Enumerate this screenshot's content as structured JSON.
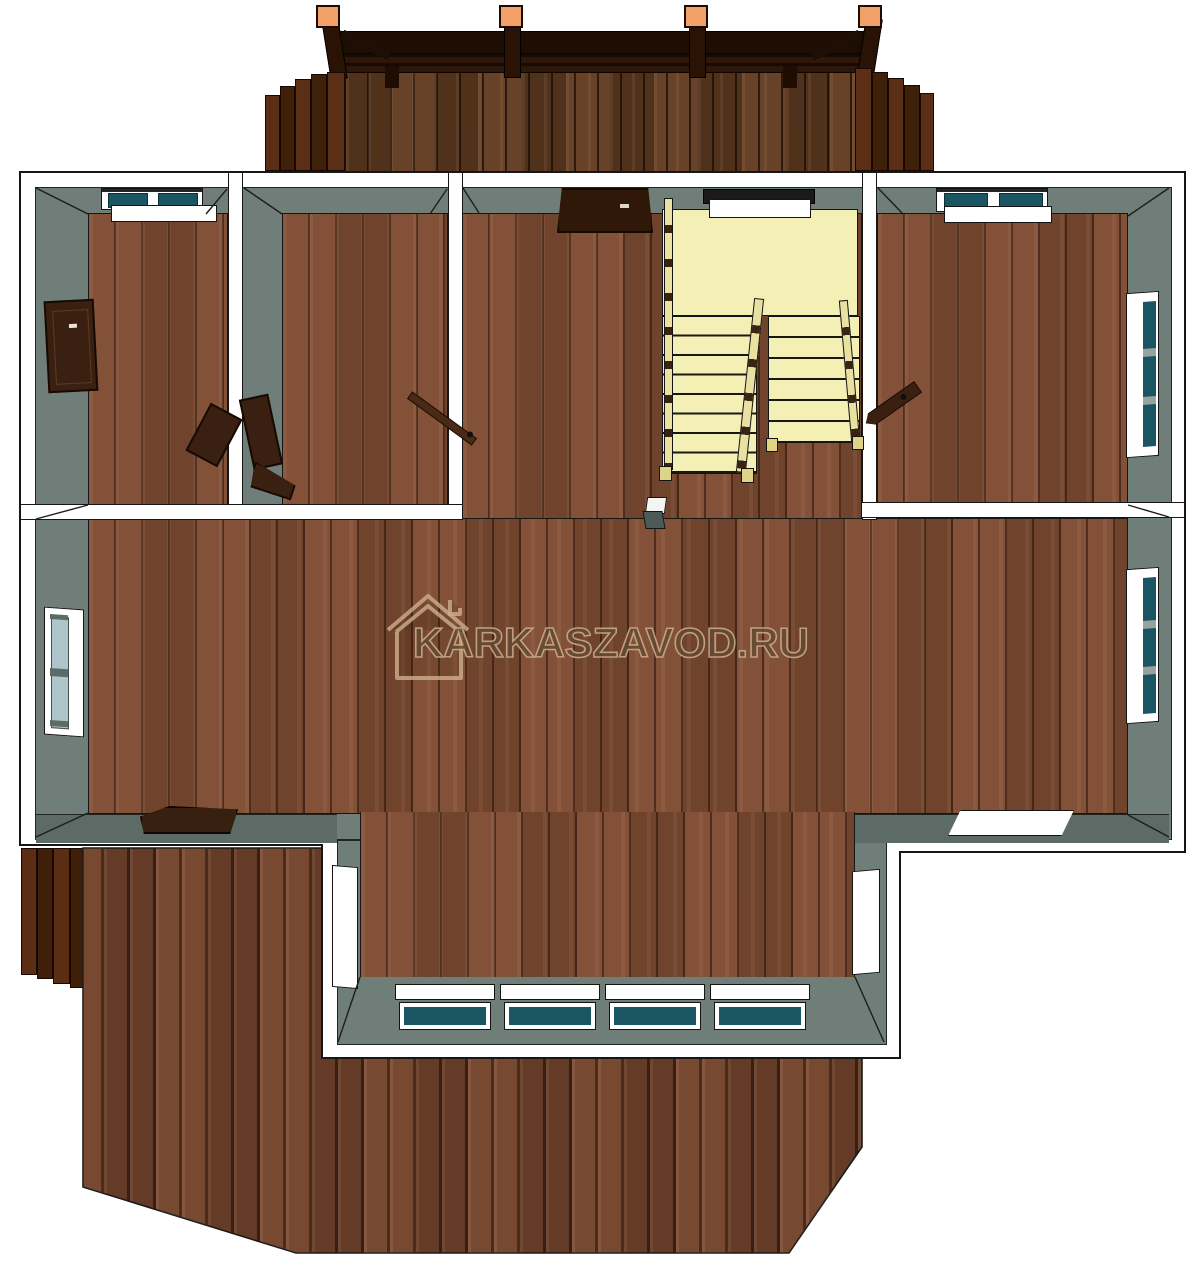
{
  "watermark": {
    "text": "KARKASZAVOD.RU",
    "icon": "house-outline-icon"
  },
  "theme": {
    "white": "#ffffff",
    "outline": "#161616",
    "wall": "#6f7e79",
    "wall-dark": "#5c6b66",
    "floor": "#7b4a31",
    "deck": "#6f422a",
    "porch": "#5e3a20",
    "stair": "#f4f0b5",
    "rail": "#e9e1a2",
    "door": "#3a2011",
    "door-dark": "#160a02",
    "glass-teal": "#1a5564",
    "glass-light": "#aec6cb",
    "mullion": "#98a3a0",
    "post-cap": "#f2a268",
    "beam": "#1e0d03",
    "wm-fill": "rgba(59,33,16,0.62)",
    "wm-stroke": "rgba(205,174,140,0.85)"
  }
}
